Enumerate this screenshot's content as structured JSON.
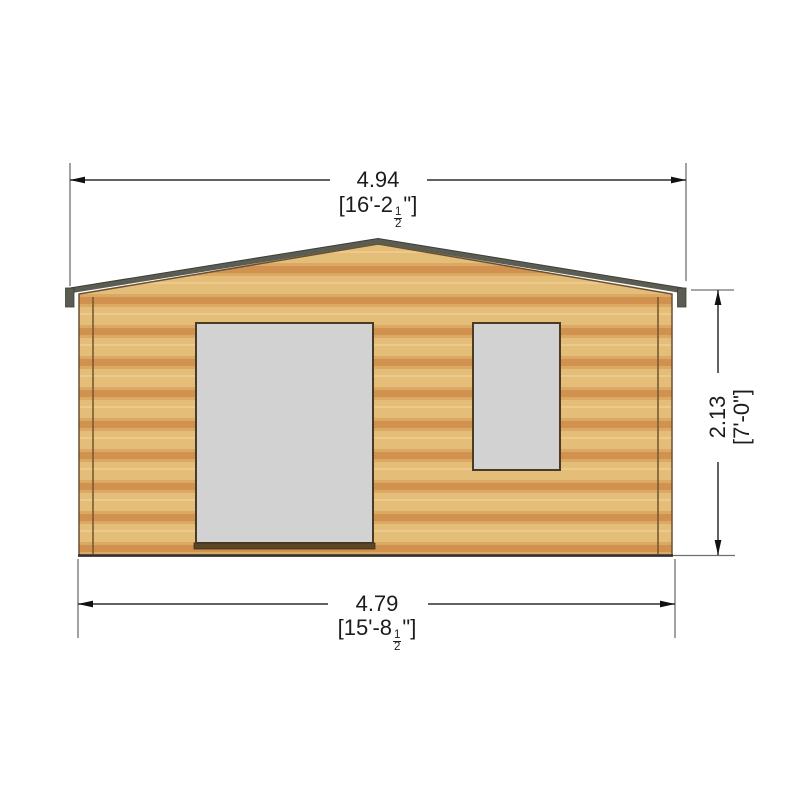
{
  "diagram": {
    "title": "garden log cabin front elevation with overall dimensions",
    "background_color": "#ffffff",
    "dimensions": {
      "top": {
        "metric": "4.94",
        "imperial_prefix": "[16'-2",
        "frac_num": "1",
        "frac_den": "2",
        "imperial_suffix": "\"]"
      },
      "bottom": {
        "metric": "4.79",
        "imperial_prefix": "[15'-8",
        "frac_num": "1",
        "frac_den": "2",
        "imperial_suffix": "\"]"
      },
      "right": {
        "metric": "2.13",
        "imperial": "[7'-0\"]"
      }
    },
    "colors": {
      "wood_light": "#e4be78",
      "wood_dark_band": "#d2924f",
      "wood_outline": "#6b5030",
      "roof": "#5b5c52",
      "roof_edge_dark": "#3e3f38",
      "door_window_fill": "#d2d2d2",
      "door_window_border": "#4a3b24",
      "door_sill": "#5a4627",
      "dimension_line": "#2e2e2e",
      "extension_line": "#6f6f6f",
      "text": "#1c1c1c"
    },
    "building": {
      "style": "horizontal log cladding, gable roof",
      "features": [
        "door",
        "window"
      ]
    }
  }
}
